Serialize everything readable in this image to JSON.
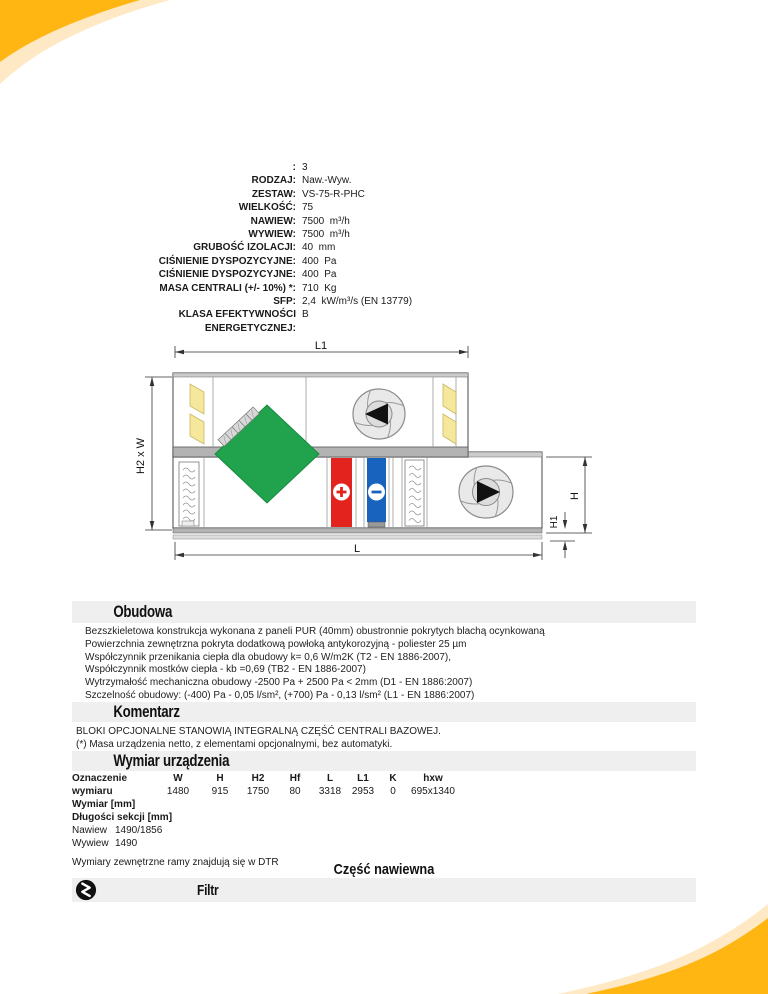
{
  "spec": {
    "rows": [
      {
        "label": ":",
        "value": "3"
      },
      {
        "label": "RODZAJ:",
        "value": "Naw.-Wyw."
      },
      {
        "label": "ZESTAW:",
        "value": "VS-75-R-PHC"
      },
      {
        "label": "WIELKOŚĆ:",
        "value": "75"
      },
      {
        "label": "NAWIEW:",
        "value": "7500  m³/h"
      },
      {
        "label": "WYWIEW:",
        "value": "7500  m³/h"
      },
      {
        "label": "GRUBOŚĆ IZOLACJI:",
        "value": "40  mm"
      },
      {
        "label": "CIŚNIENIE DYSPOZYCYJNE:",
        "value": "400  Pa"
      },
      {
        "label": "CIŚNIENIE DYSPOZYCYJNE:",
        "value": "400  Pa"
      },
      {
        "label": "MASA CENTRALI (+/- 10%) *:",
        "value": "710  Kg"
      },
      {
        "label": "SFP:",
        "value": "2,4  kW/m³/s (EN 13779)"
      },
      {
        "label": "KLASA EFEKTYWNOŚCI",
        "value": "B"
      },
      {
        "label": "ENERGETYCZNEJ:",
        "value": ""
      }
    ]
  },
  "diagram": {
    "dim_l1": "L1",
    "dim_h2w": "H2 x W",
    "dim_l": "L",
    "dim_h": "H",
    "dim_h1": "H1",
    "icons": {
      "filter": "zigzag-in-circle",
      "heater": "+",
      "cooler": "−",
      "supply_fan": "right-triangle-impeller",
      "exhaust_fan": "left-triangle-impeller",
      "heat_exchanger": "green-diamond-rotor"
    }
  },
  "sections": {
    "obudowa": {
      "title": "Obudowa",
      "lines": [
        "Bezszkieletowa konstrukcja wykonana z paneli PUR (40mm) obustronnie pokrytych blachą ocynkowaną",
        "Powierzchnia zewnętrzna pokryta dodatkową powłoką antykorozyjną - poliester 25 µm",
        "Współczynnik przenikania ciepła dla obudowy k= 0,6 W/m2K (T2 - EN 1886-2007),",
        "Współczynnik mostków ciepła - kb =0,69 (TB2 - EN 1886-2007)",
        "Wytrzymałość mechaniczna obudowy -2500 Pa + 2500 Pa < 2mm (D1 - EN 1886:2007)",
        "Szczelność obudowy: (-400) Pa - 0,05 l/sm², (+700) Pa - 0,13 l/sm² (L1 - EN 1886:2007)"
      ]
    },
    "komentarz": {
      "title": "Komentarz",
      "lines": [
        "BLOKI OPCJONALNE STANOWIĄ INTEGRALNĄ CZĘŚĆ CENTRALI BAZOWEJ.",
        "(*) Masa urządzenia netto, z elementami opcjonalnymi, bez automatyki."
      ]
    },
    "wymiar": {
      "title": "Wymiar urządzenia",
      "table": {
        "row_label_line1": "Oznaczenie",
        "row_label_line2": "wymiaru",
        "row_label_line3": "Wymiar [mm]",
        "columns": [
          "W",
          "H",
          "H2",
          "Hf",
          "L",
          "L1",
          "K",
          "hxw"
        ],
        "values": [
          "1480",
          "915",
          "1750",
          "80",
          "3318",
          "2953",
          "0",
          "695x1340"
        ]
      },
      "lengths_title": "Długości sekcji [mm]",
      "lengths": [
        {
          "label": "Nawiew",
          "value": "1490/1856"
        },
        {
          "label": "Wywiew",
          "value": "1490"
        }
      ],
      "note": "Wymiary zewnętrzne ramy znajdują się w DTR"
    },
    "czesc_nawiewna": {
      "title": "Część nawiewna"
    },
    "filtr": {
      "title": "Filtr"
    }
  },
  "colors": {
    "accent_amber": "#FFB612",
    "accent_cream": "#FFE9C4",
    "exchanger_green": "#21A24C",
    "heater_red": "#E3231E",
    "cooler_blue": "#1763BE",
    "filter_yellow": "#F5E79B",
    "section_bar_gray": "#EFEFEF"
  }
}
